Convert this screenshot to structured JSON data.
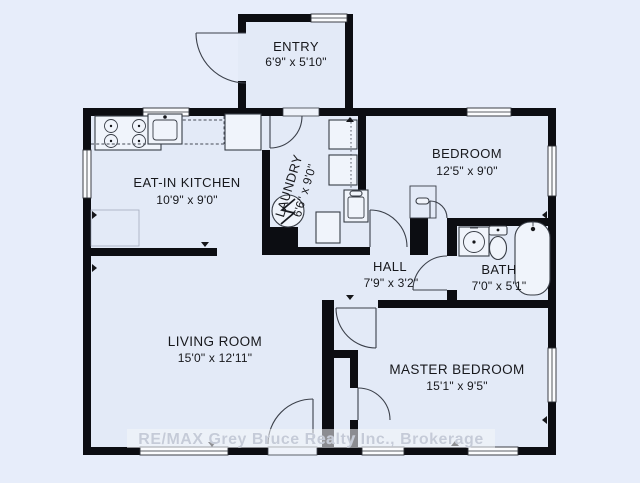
{
  "watermark": "RE/MAX Grey Bruce Realty Inc., Brokerage",
  "rooms": [
    {
      "name": "ENTRY",
      "dims": "6'9\" x 5'10\""
    },
    {
      "name": "EAT-IN KITCHEN",
      "dims": "10'9\" x 9'0\""
    },
    {
      "name": "LAUNDRY",
      "dims": "6'6\" x 9'0\""
    },
    {
      "name": "BEDROOM",
      "dims": "12'5\" x 9'0\""
    },
    {
      "name": "HALL",
      "dims": "7'9\" x 3'2\""
    },
    {
      "name": "BATH",
      "dims": "7'0\" x 5'1\""
    },
    {
      "name": "LIVING ROOM",
      "dims": "15'0\" x 12'11\""
    },
    {
      "name": "MASTER BEDROOM",
      "dims": "15'1\" x 9'5\""
    }
  ],
  "fixtures": [
    "stove",
    "kitchen-sink",
    "refrigerator",
    "washer",
    "dryer",
    "laundry-tub",
    "furnace",
    "freezer",
    "linen-shelf",
    "vanity-sink",
    "toilet",
    "bathtub"
  ],
  "colors": {
    "background": "#e7edfa",
    "floor": "#e3eaf7",
    "wall": "#0c0d12",
    "fixture_stroke": "#383d46",
    "watermark_text": "#c5cbd8",
    "label_text": "#17181c"
  }
}
